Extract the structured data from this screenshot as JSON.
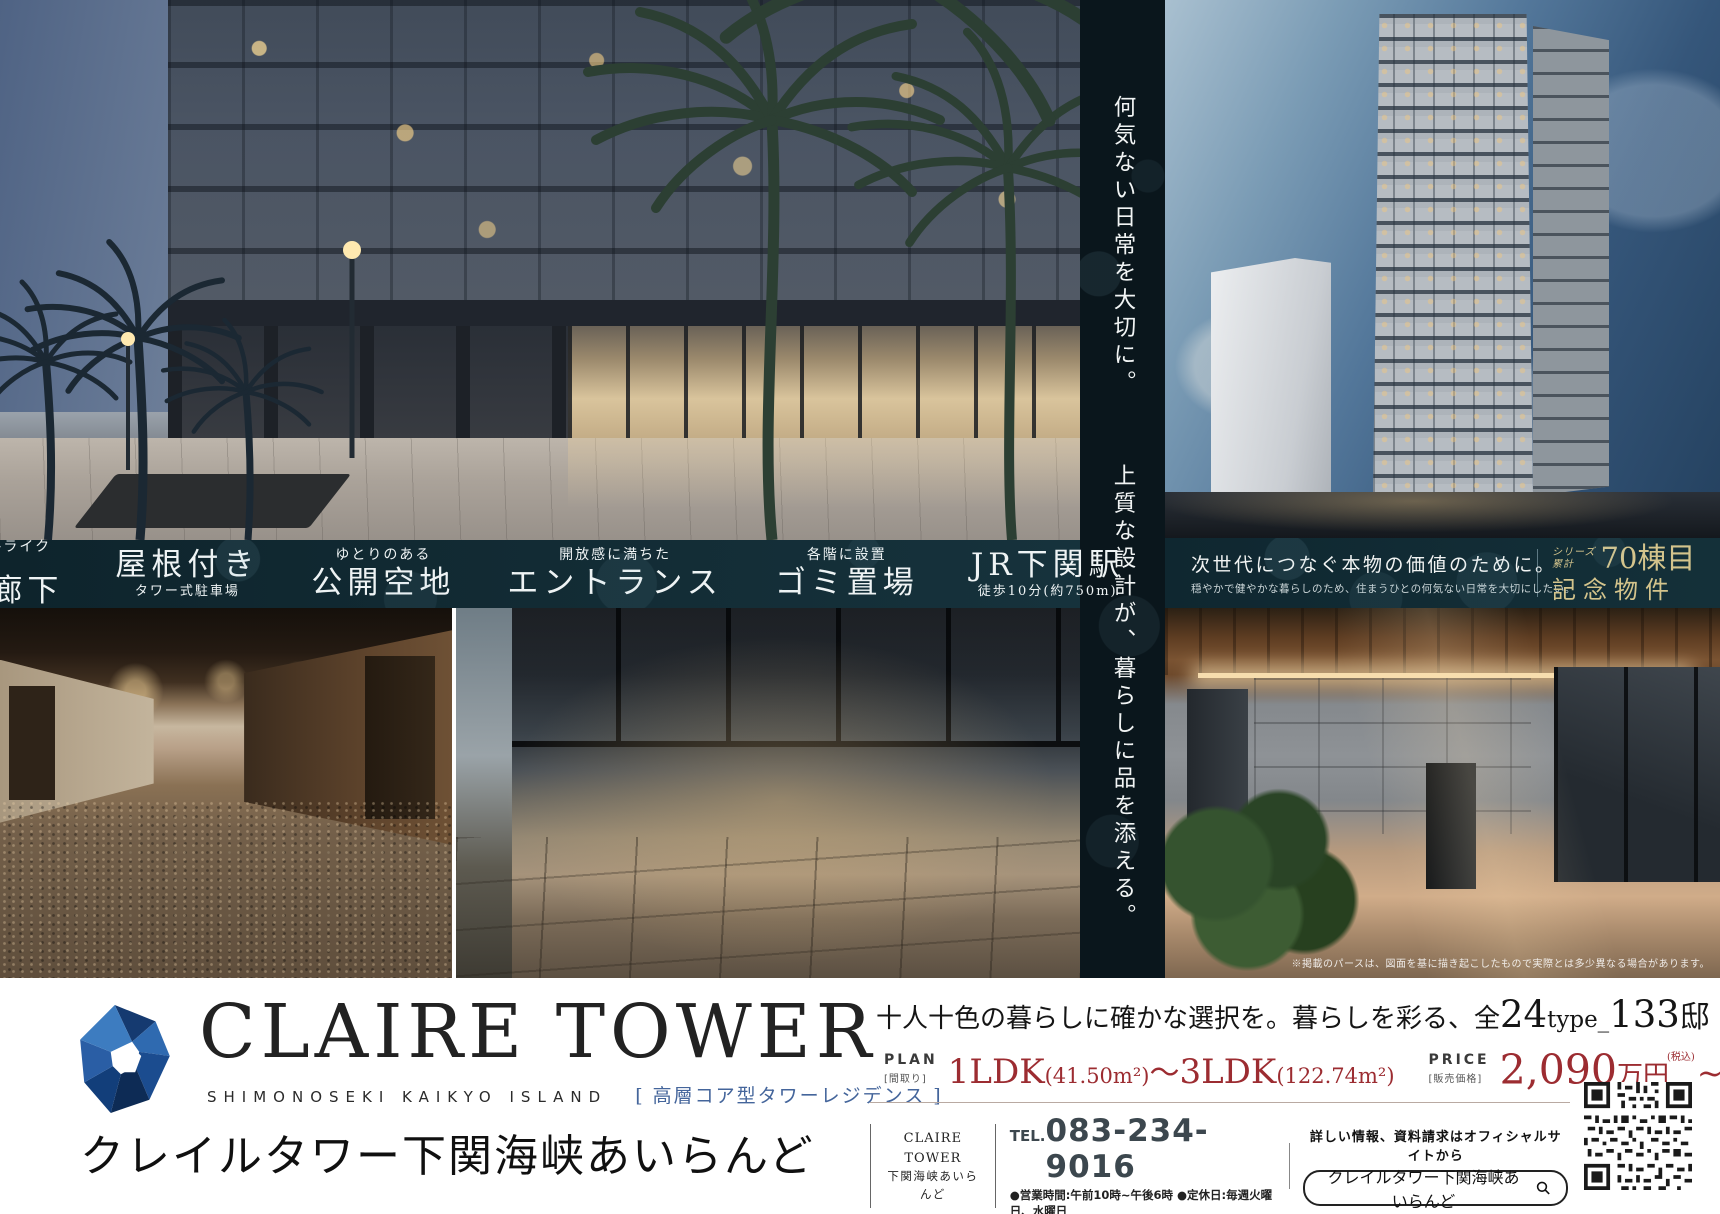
{
  "features": [
    {
      "top": "ホテルライクな",
      "main": "内廊下"
    },
    {
      "main": "屋根付き",
      "bottom": "タワー式駐車場"
    },
    {
      "top": "ゆとりのある",
      "main": "公開空地"
    },
    {
      "top": "開放感に満ちた",
      "main": "エントランス"
    },
    {
      "top": "各階に設置",
      "main": "ゴミ置場"
    },
    {
      "main": "JR下関駅",
      "bottom": "徒歩10分(約750m)"
    }
  ],
  "vertical_copy": {
    "s1": "何気ない日常を大切に。",
    "s2": "上質な設計が、暮らしに品を添える。"
  },
  "tower_caption": {
    "headline": "次世代につなぐ本物の価値のために。",
    "subline": "穏やかで健やかな暮らしのため、住まうひとの何気ない日常を大切にしたい。",
    "series_line1": "シリーズ",
    "series_line2": "累計",
    "series_num": "70棟目",
    "series_sub": "記念物件"
  },
  "disclaimer": "※掲載のパースは、図面を基に描き起こしたもので実際とは多少異なる場合があります。",
  "brand": {
    "logo": "CLAIRE TOWER",
    "sub_en": "SHIMONOSEKI KAIKYO ISLAND",
    "sub_jp": "[ 高層コア型タワーレジデンス ]",
    "name_jp": "クレイルタワー下関海峡あいらんど"
  },
  "offer": {
    "h1": "十人十色の暮らしに確かな選択を。暮らしを彩る、全",
    "h2": "24",
    "h3": "type_",
    "h4": "133",
    "h5": "邸"
  },
  "plan": {
    "label": "PLAN",
    "sublabel": "[間取り]",
    "v1": "1LDK",
    "a1": "(41.50m²)",
    "tilde": "〜",
    "v2": "3LDK",
    "a2": "(122.74m²)"
  },
  "price": {
    "label": "PRICE",
    "sublabel": "[販売価格]",
    "v1": "2,090",
    "u1": "万円",
    "tax1": "(税込)",
    "tilde": "~",
    "v2": "10,000",
    "u2": "万円",
    "tax2": "(税込)"
  },
  "contact": {
    "box1": "CLAIRE TOWER",
    "box2": "下関海峡あいらんど",
    "tel_label": "TEL.",
    "tel": "083-234-9016",
    "hours": "●営業時間:午前10時~午後6時 ●定休日:毎週火曜日、水曜日",
    "note": "詳しい情報、資料請求はオフィシャルサイトから",
    "search": "クレイルタワー下関海峡あいらんど"
  },
  "colors": {
    "band": "#10262e",
    "strip": "#0a161c",
    "accent_gold": "#d4c48c",
    "price_red": "#9c2c31",
    "link_blue": "#44659b",
    "logo_navy": "#1b3a6b"
  }
}
